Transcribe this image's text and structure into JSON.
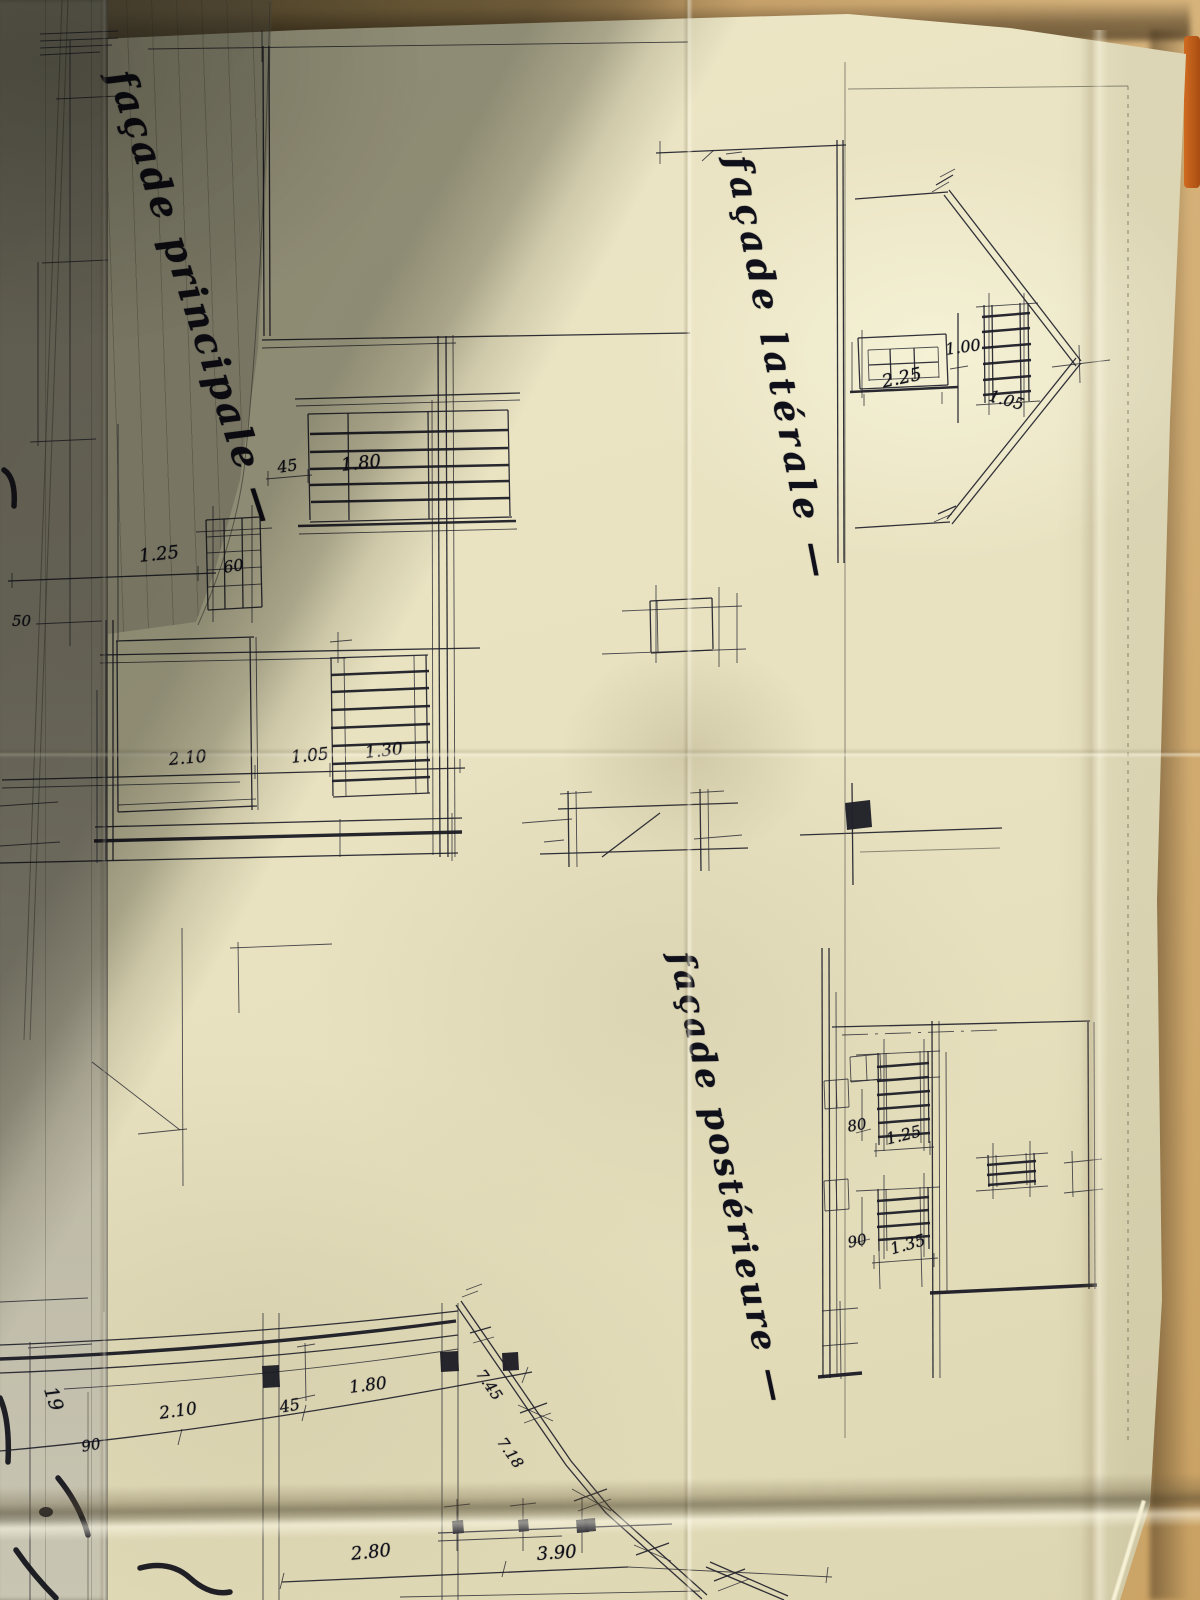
{
  "labels": {
    "principale": "façade principale —",
    "laterale": "façade latérale —",
    "posterieure": "façade postérieure —"
  },
  "dims": {
    "left_50": "50",
    "left_19": "19",
    "left_90": "90",
    "fp_45": "45",
    "fp_180": "1.80",
    "fp_125": "1.25",
    "fp_60": "60",
    "fp_210": "2.10",
    "fp_105": "1.05",
    "fp_130": "1.30",
    "fl_225": "2.25",
    "fl_100": "1.00",
    "fl_105": "1.05",
    "po_80": "80",
    "po_125": "1.25",
    "po_90": "90",
    "po_135": "1.35",
    "fe_210": "2.10",
    "fe_45": "45",
    "fe_180": "1.80",
    "fe_745": "7.45",
    "fe_718": "7.18",
    "fe_280": "2.80",
    "fe_390": "3.90"
  },
  "colors": {
    "ink": "#23232c",
    "paper_lit": "#ece7c6",
    "paper_shadow": "#8e8a74",
    "desk": "#c9a76c",
    "orange_object": "#c05a1a"
  }
}
